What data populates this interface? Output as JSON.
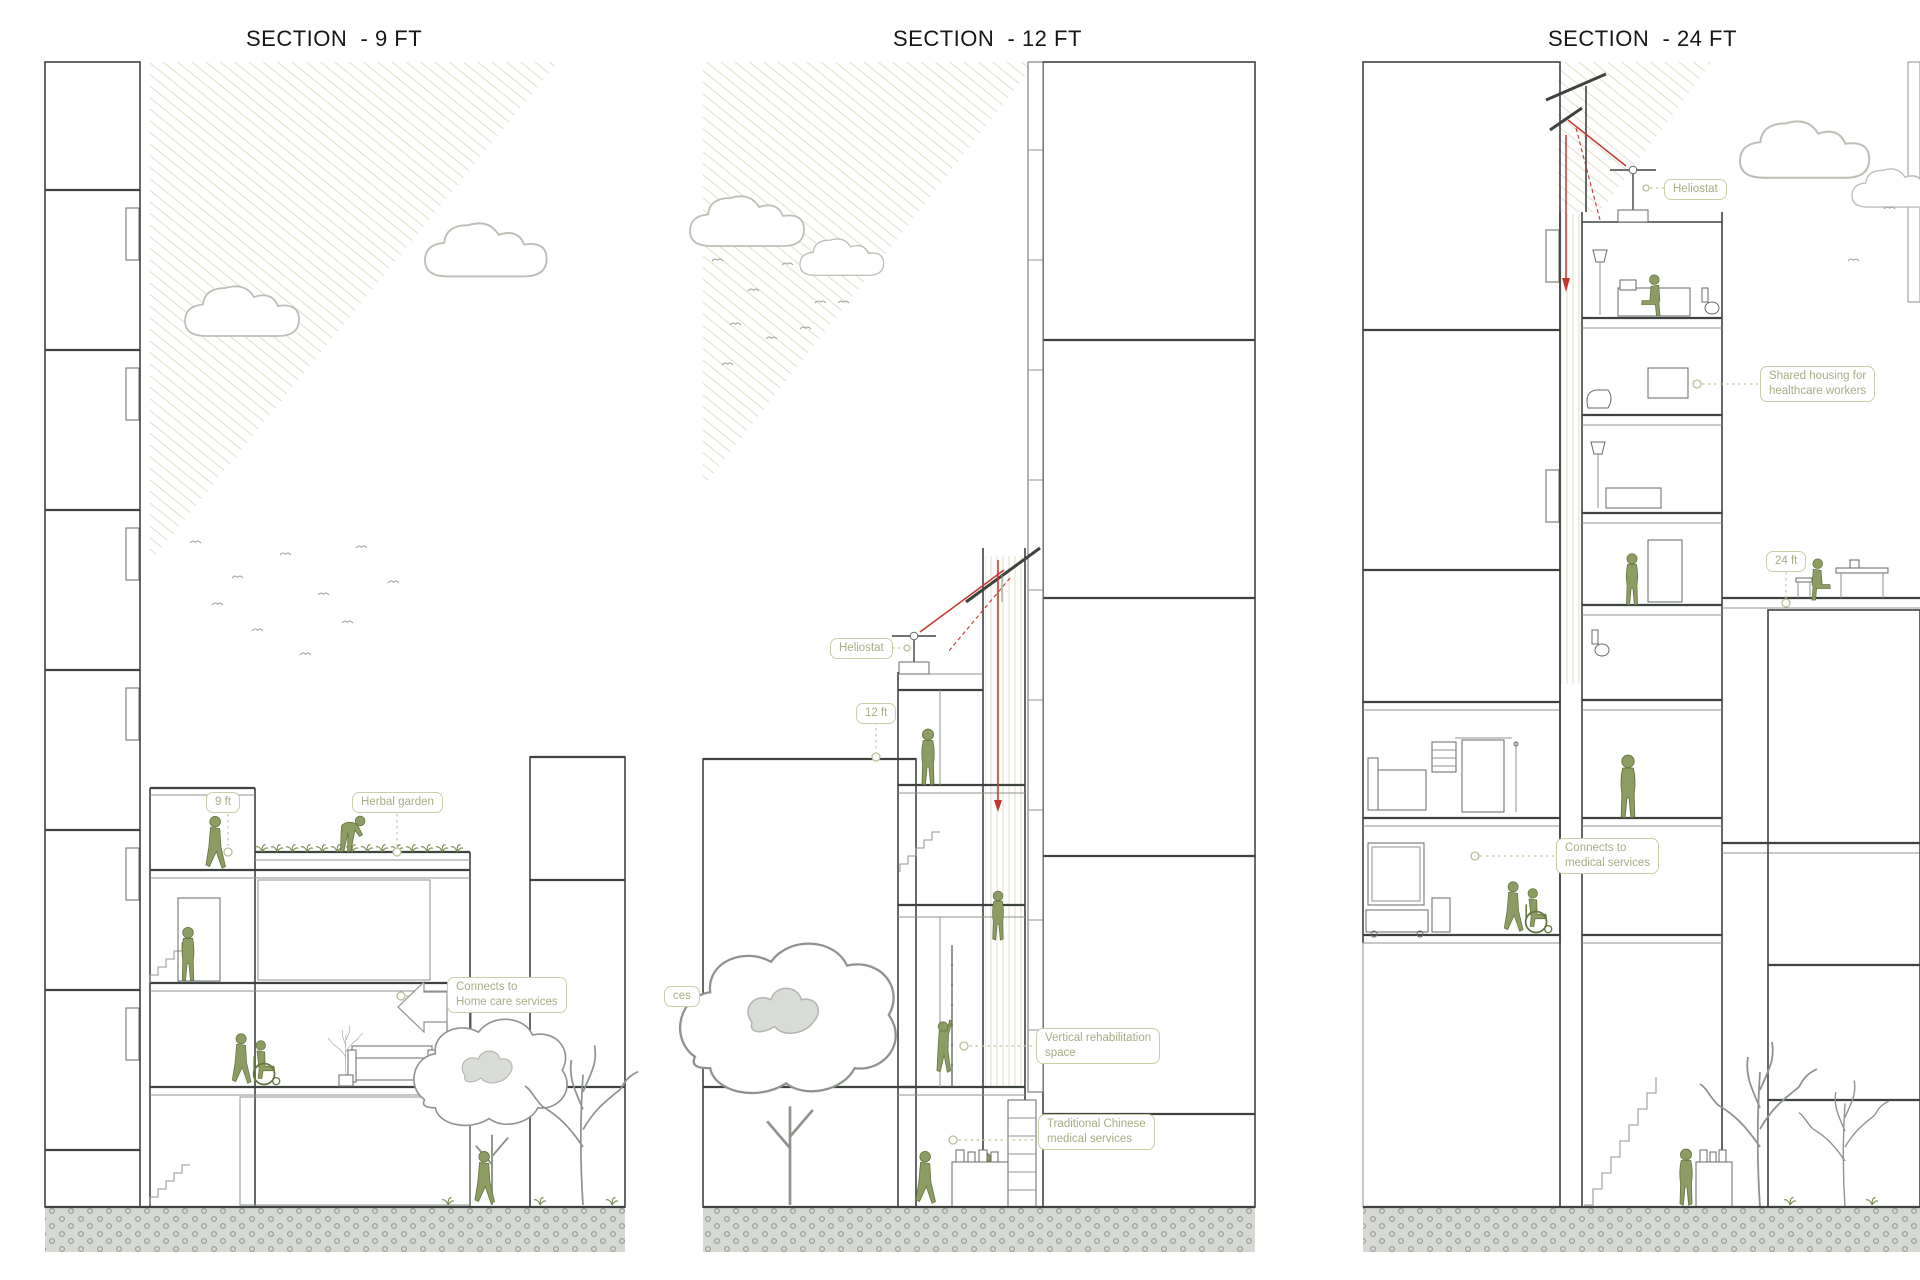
{
  "colors": {
    "figure_green": "#8d9c63",
    "annotation_olive": "#a6ad84",
    "annotation_border": "#c9cea7",
    "sunbeam_red": "#c4372e",
    "concrete_gray": "#dbddd9",
    "sun_hatch": "#e3decb"
  },
  "sections": [
    {
      "id": "section-9ft",
      "title": "SECTION  - 9 FT",
      "annotations": {
        "height_marker": "9 ft",
        "herbal_garden": "Herbal garden",
        "connects_line1": "Connects to",
        "connects_line2": "Home care services"
      }
    },
    {
      "id": "section-12ft",
      "title": "SECTION  - 12 FT",
      "annotations": {
        "heliostat": "Heliostat",
        "height_marker": "12 ft",
        "rehab_line1": "Vertical rehabilitation",
        "rehab_line2": "space",
        "tcm_line1": "Traditional Chinese",
        "tcm_line2": "medical services",
        "partial_label": "ces"
      }
    },
    {
      "id": "section-24ft",
      "title": "SECTION  - 24 FT",
      "annotations": {
        "heliostat": "Heliostat",
        "shared_line1": "Shared housing for",
        "shared_line2": "healthcare workers",
        "height_marker": "24 ft",
        "connects_line1": "Connects to",
        "connects_line2": "medical services"
      }
    }
  ]
}
